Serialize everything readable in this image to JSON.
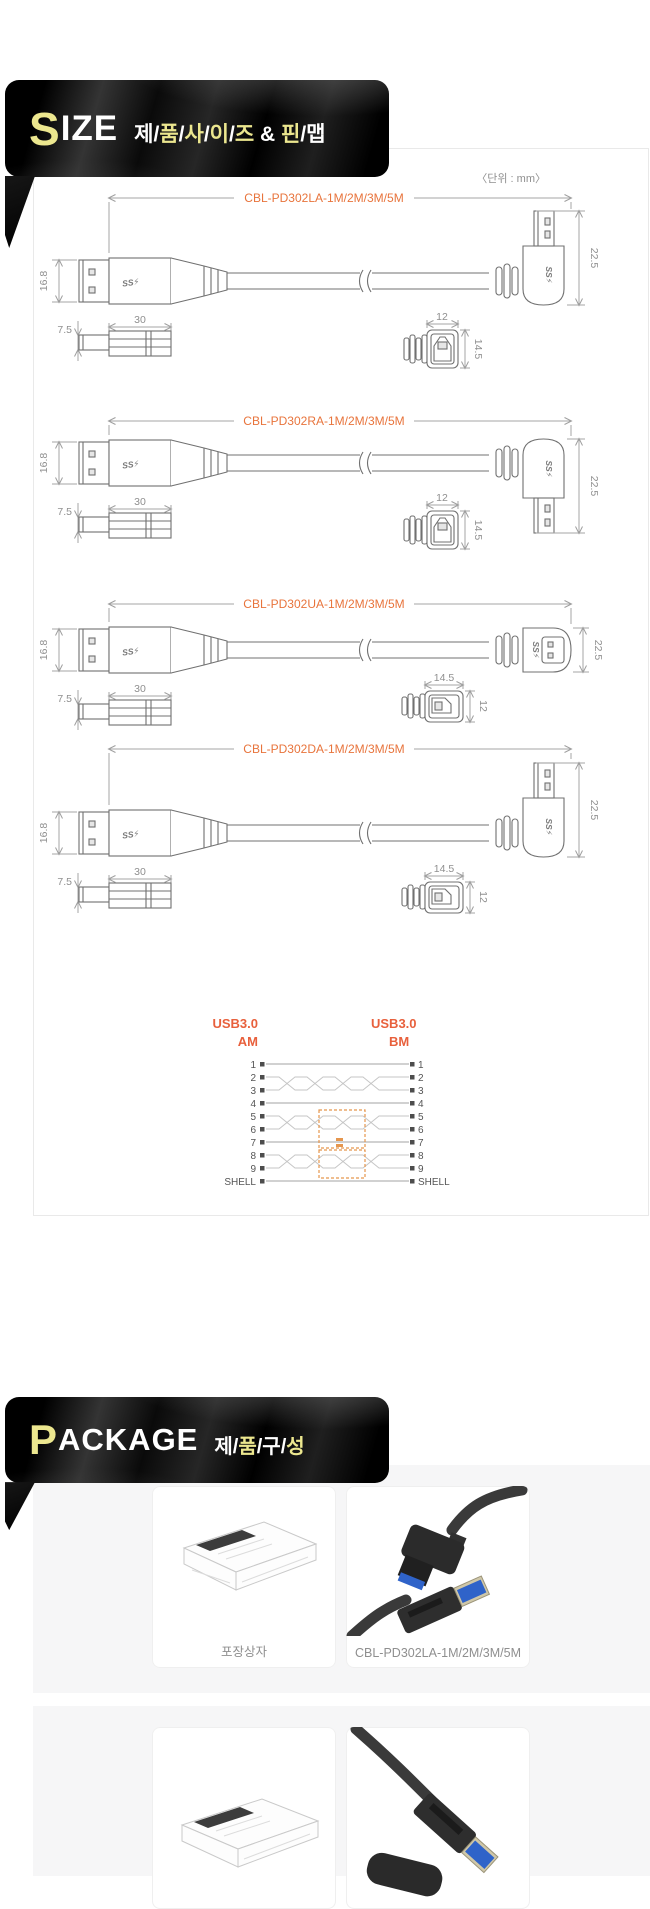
{
  "size_section": {
    "title_lead": "S",
    "title_rest": "IZE",
    "subtitle_parts": [
      "제",
      "/",
      "품",
      "/",
      "사",
      "/",
      "이",
      "/",
      "즈",
      " & ",
      "핀",
      "/",
      "맵"
    ],
    "unit_note": "〈단위 : mm〉",
    "ss_logo": "SS⚡",
    "diagrams": [
      {
        "model": "CBL-PD302LA-1M/2M/3M/5M",
        "a_height": "16.8",
        "b_height": "22.5",
        "a_side_height": "7.5",
        "a_body_length": "30",
        "b_end_width": "12",
        "b_end_height": "14.5"
      },
      {
        "model": "CBL-PD302RA-1M/2M/3M/5M",
        "a_height": "16.8",
        "b_height": "22.5",
        "a_side_height": "7.5",
        "a_body_length": "30",
        "b_end_width": "12",
        "b_end_height": "14.5"
      },
      {
        "model": "CBL-PD302UA-1M/2M/3M/5M",
        "a_height": "16.8",
        "b_height": "22.5",
        "a_side_height": "7.5",
        "a_body_length": "30",
        "b_end_width": "14.5",
        "b_end_height": "12"
      },
      {
        "model": "CBL-PD302DA-1M/2M/3M/5M",
        "a_height": "16.8",
        "b_height": "22.5",
        "a_side_height": "7.5",
        "a_body_length": "30",
        "b_end_width": "14.5",
        "b_end_height": "12"
      }
    ],
    "pinmap": {
      "left_title": "USB3.0",
      "left_sub": "AM",
      "right_title": "USB3.0",
      "right_sub": "BM",
      "pins": [
        "1",
        "2",
        "3",
        "4",
        "5",
        "6",
        "7",
        "8",
        "9",
        "SHELL"
      ]
    }
  },
  "package_section": {
    "title_lead": "P",
    "title_rest": "ACKAGE",
    "subtitle_parts": [
      "제",
      "/",
      "품",
      "/",
      "구",
      "/",
      "성"
    ],
    "cards": [
      {
        "caption": "포장상자"
      },
      {
        "caption": "CBL-PD302LA-1M/2M/3M/5M"
      }
    ]
  },
  "colors": {
    "accent_orange": "#e8743c",
    "banner_yellow": "#ece78f",
    "banner_black": "#0a0a0a",
    "dim_gray": "#9f9f9f"
  }
}
